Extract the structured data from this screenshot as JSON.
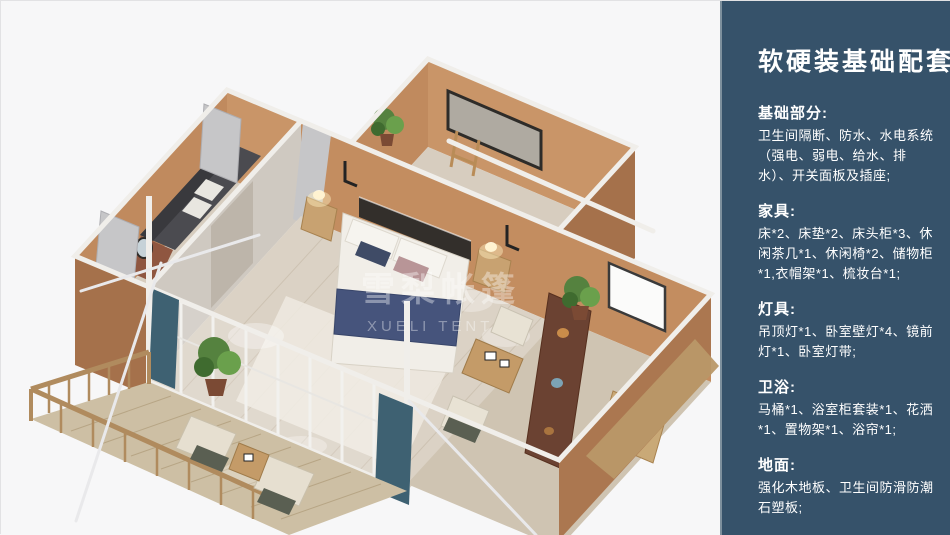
{
  "panel": {
    "title": "软硬装基础配套",
    "background_color": "#36526A",
    "edge_highlight_color": "#7E909D",
    "text_color": "#FFFFFF",
    "sections": [
      {
        "title": "基础部分:",
        "body": "卫生间隔断、防水、水电系统（强电、弱电、给水、排水）、开关面板及插座;"
      },
      {
        "title": "家具:",
        "body": "床*2、床垫*2、床头柜*3、休闲茶几*1、休闲椅*2、储物柜*1,衣帽架*1、梳妆台*1;"
      },
      {
        "title": "灯具:",
        "body": "吊顶灯*1、卧室壁灯*4、镜前灯*1、卧室灯带;"
      },
      {
        "title": "卫浴:",
        "body": "马桶*1、浴室柜套装*1、花洒*1、置物架*1、浴帘*1;"
      },
      {
        "title": "地面:",
        "body": "强化木地板、卫生间防滑防潮石塑板;"
      }
    ]
  },
  "illustration": {
    "description": "isometric 3D floor plan of modular tent home with bedroom, lounge, bathroom wing and wooden deck",
    "watermark_cn": "雪梨帐篷",
    "watermark_en": "XUELI TENT",
    "colors": {
      "background": "#F7F7F8",
      "wall_outer": "#A5714B",
      "wall_inner": "#C38D60",
      "frame_white": "#F0EEEA",
      "floor_wood": "#DBD2C5",
      "deck_wood": "#CDBFA4",
      "bed_blanket_navy": "#46547C",
      "curtain_gray": "#C6C6C8",
      "curtain_teal": "#3E6172",
      "plant_green": "#5E8F43",
      "shelf_brown": "#6B4232"
    }
  }
}
